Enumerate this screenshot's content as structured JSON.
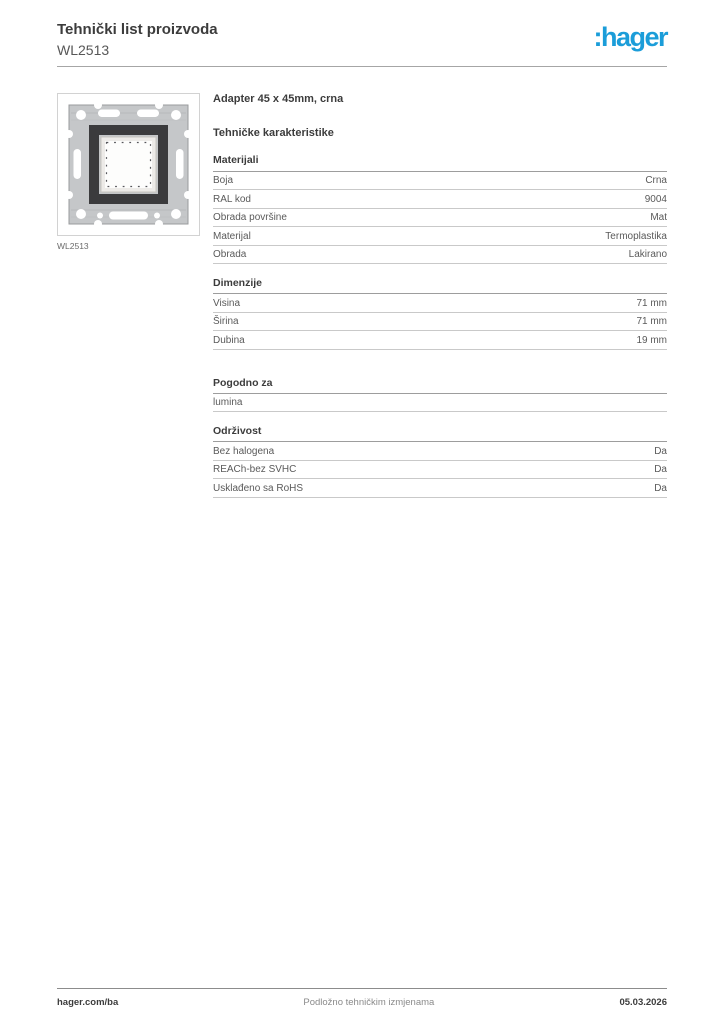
{
  "header": {
    "title": "Tehnički list proizvoda",
    "subtitle": "WL2513",
    "logo_text": ":hager",
    "brand_color": "#1b9dd9"
  },
  "product": {
    "caption": "WL2513",
    "image_name": "adapter-frame-line-drawing"
  },
  "main": {
    "product_title": "Adapter 45 x 45mm, crna",
    "characteristics_heading": "Tehničke karakteristike",
    "sections": [
      {
        "title": "Materijali",
        "rows": [
          {
            "label": "Boja",
            "value": "Crna"
          },
          {
            "label": "RAL kod",
            "value": "9004"
          },
          {
            "label": "Obrada površine",
            "value": "Mat"
          },
          {
            "label": "Materijal",
            "value": "Termoplastika"
          },
          {
            "label": "Obrada",
            "value": "Lakirano"
          }
        ]
      },
      {
        "title": "Dimenzije",
        "rows": [
          {
            "label": "Visina",
            "value": "71 mm"
          },
          {
            "label": "Širina",
            "value": "71 mm"
          },
          {
            "label": "Dubina",
            "value": "19 mm"
          }
        ]
      },
      {
        "title": "Pogodno za",
        "rows": [
          {
            "label": "lumina",
            "value": ""
          }
        ]
      },
      {
        "title": "Održivost",
        "rows": [
          {
            "label": "Bez halogena",
            "value": "Da"
          },
          {
            "label": "REACh-bez SVHC",
            "value": "Da"
          },
          {
            "label": "Usklađeno sa RoHS",
            "value": "Da"
          }
        ]
      }
    ]
  },
  "footer": {
    "left": "hager.com/ba",
    "center": "Podložno tehničkim izmjenama",
    "right": "05.03.2026"
  }
}
